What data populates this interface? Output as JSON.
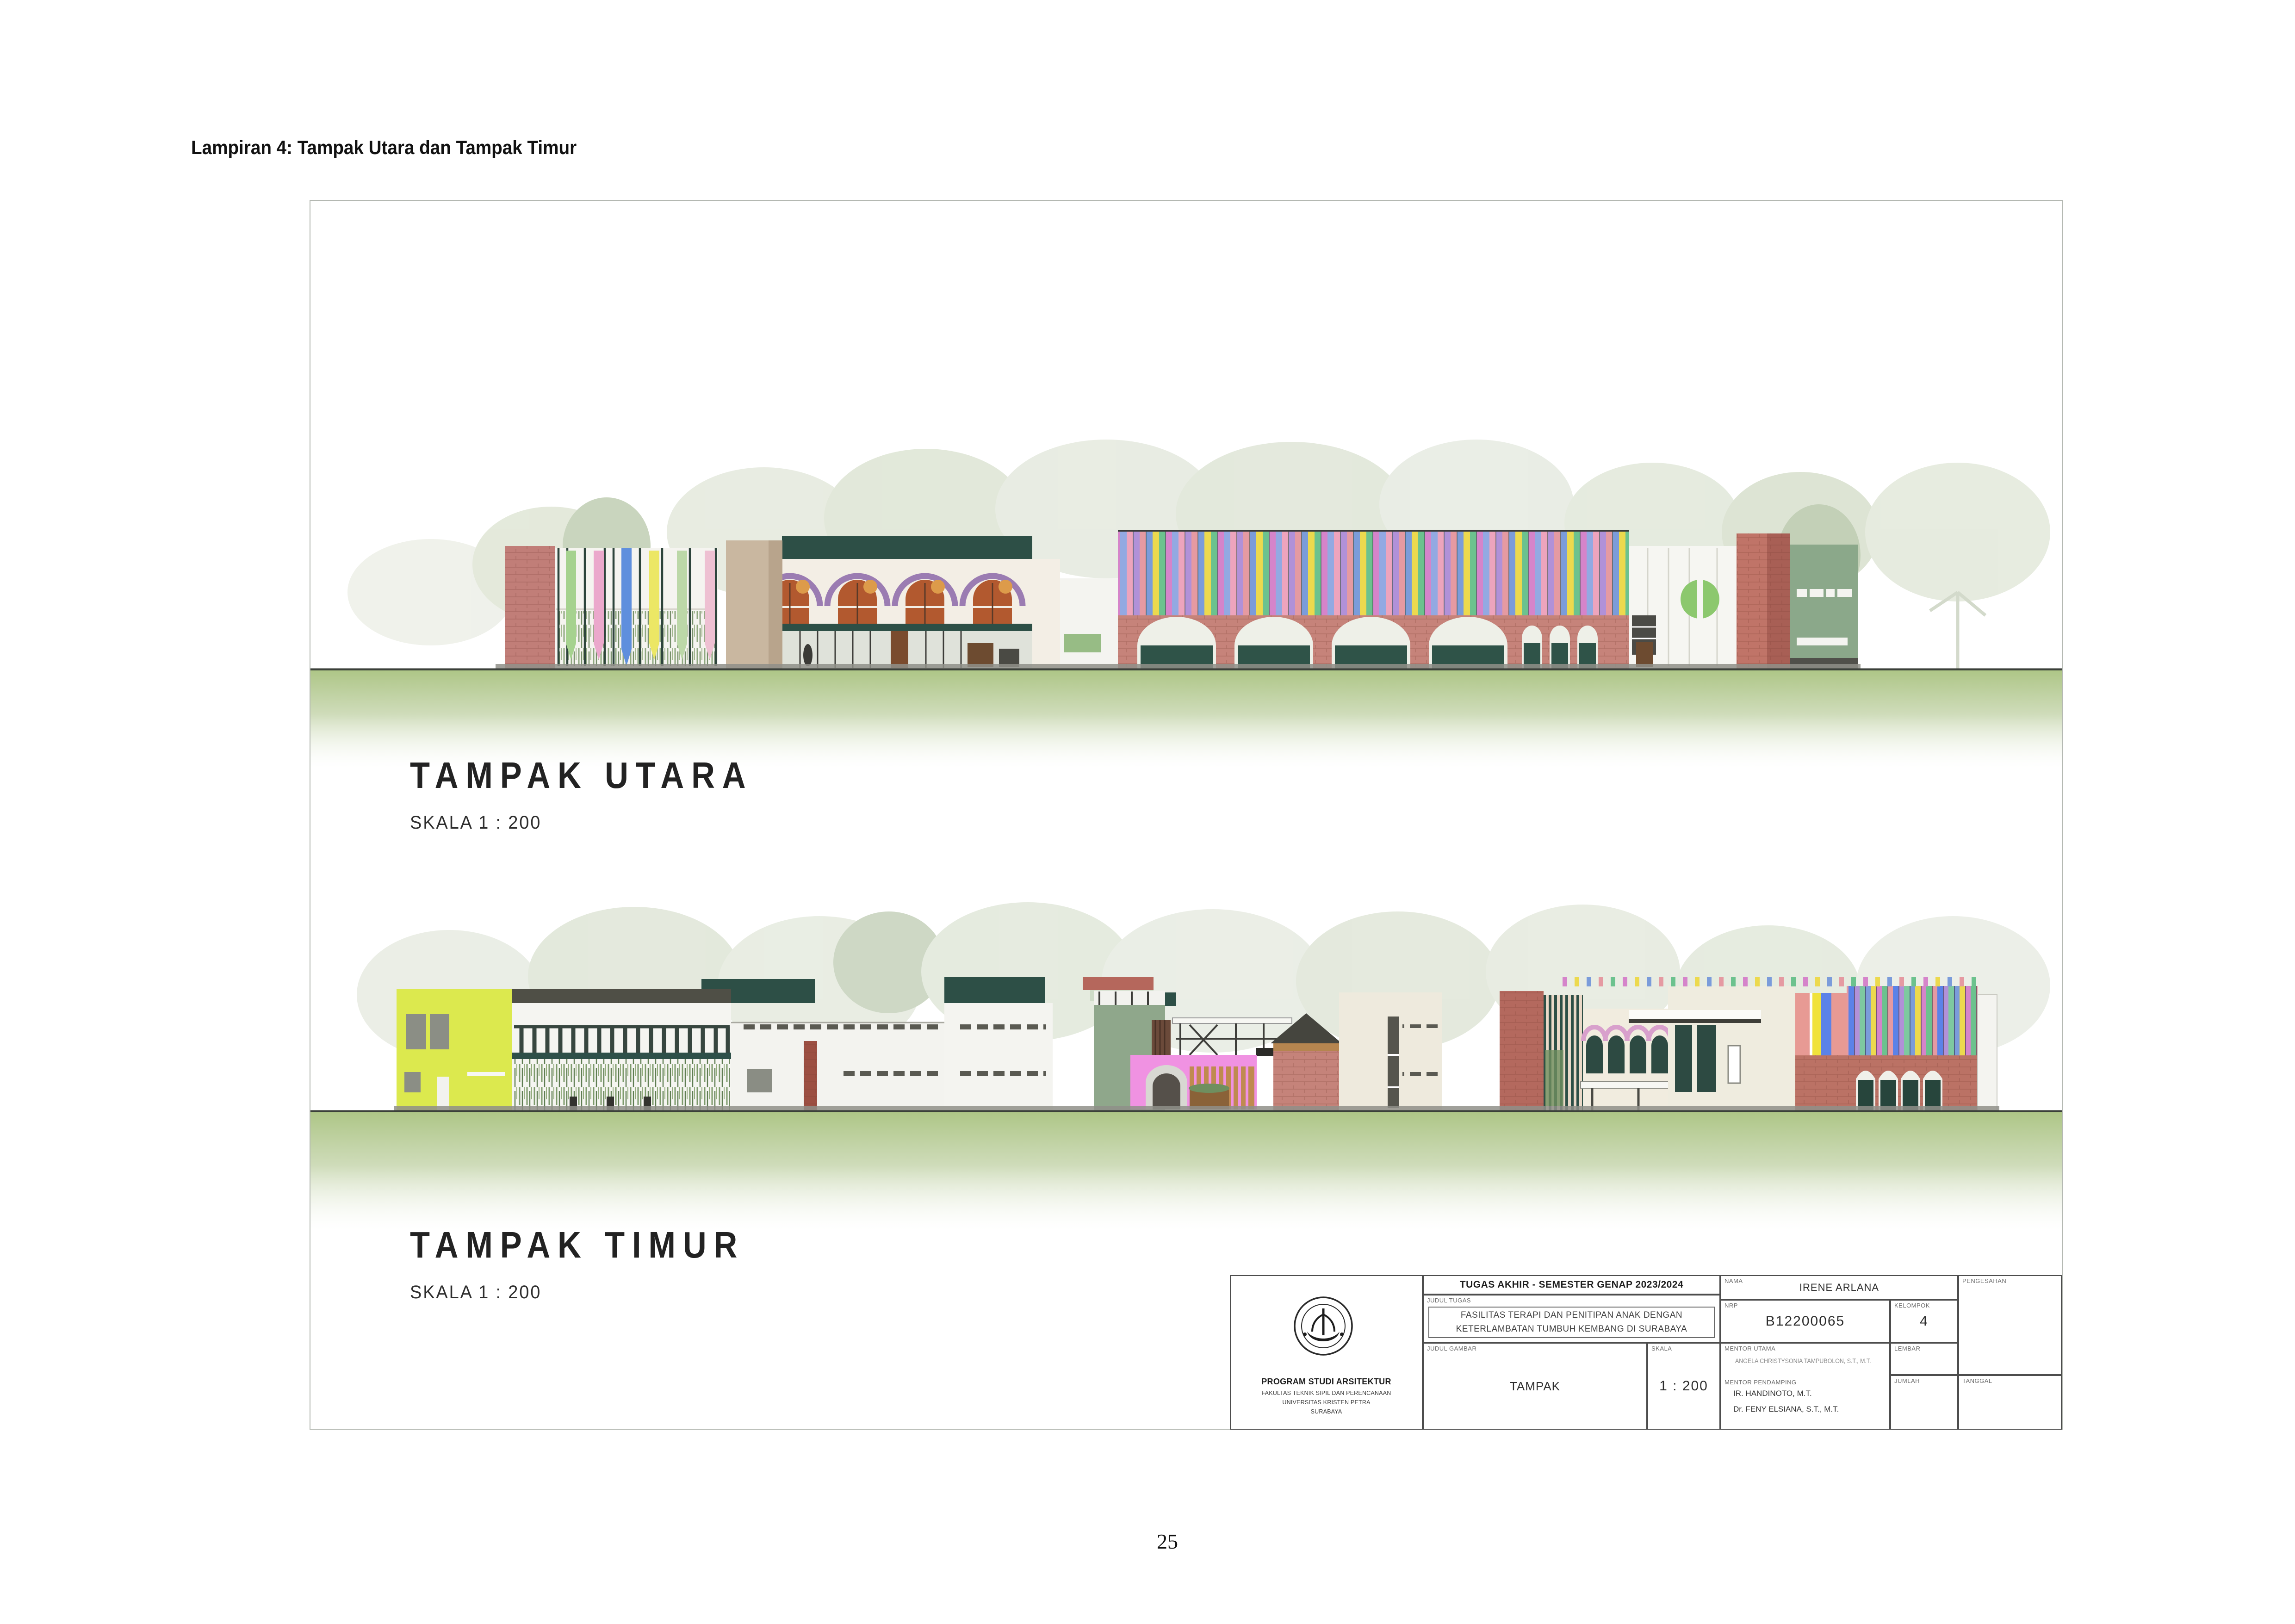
{
  "page": {
    "header": "Lampiran 4: Tampak Utara dan Tampak Timur",
    "page_number": "25"
  },
  "drawings": [
    {
      "id": "north",
      "title": "TAMPAK UTARA",
      "scale_label": "SKALA 1 : 200"
    },
    {
      "id": "east",
      "title": "TAMPAK TIMUR",
      "scale_label": "SKALA 1 : 200"
    }
  ],
  "title_block": {
    "institution": {
      "logo": "universitas-kristen-petra-seal",
      "program": "PROGRAM STUDI ARSITEKTUR",
      "faculty": "FAKULTAS TEKNIK SIPIL DAN PERENCANAAN",
      "university": "UNIVERSITAS KRISTEN PETRA",
      "city": "SURABAYA"
    },
    "project": {
      "header": "TUGAS AKHIR - SEMESTER GENAP 2023/2024",
      "judul_tugas_label": "JUDUL TUGAS",
      "judul_tugas_line1": "FASILITAS TERAPI DAN PENITIPAN ANAK DENGAN",
      "judul_tugas_line2": "KETERLAMBATAN TUMBUH KEMBANG DI SURABAYA",
      "judul_gambar_label": "JUDUL GAMBAR",
      "judul_gambar": "TAMPAK",
      "skala_label": "SKALA",
      "skala": "1 : 200"
    },
    "student": {
      "nama_label": "NAMA",
      "nama": "IRENE ARLANA",
      "nrp_label": "NRP",
      "nrp": "B12200065",
      "kelompok_label": "KELOMPOK",
      "kelompok": "4"
    },
    "mentors": {
      "mentor_utama_label": "MENTOR UTAMA",
      "mentor_utama": "ANGELA CHRISTYSONIA TAMPUBOLON, S.T., M.T.",
      "mentor_pendamping_label": "MENTOR PENDAMPING",
      "mentor_pendamping_1": "IR. HANDINOTO, M.T.",
      "mentor_pendamping_2": "Dr. FENY ELSIANA, S.T., M.T."
    },
    "admin": {
      "lembar_label": "LEMBAR",
      "jumlah_label": "JUMLAH",
      "tanggal_label": "TANGGAL",
      "pengesahan_label": "PENGESAHAN"
    }
  },
  "colors": {
    "ground_green": "#aec687",
    "brick_pink": "#c6837a",
    "brick_red": "#a85f55",
    "dark_teal": "#2d4f46",
    "sage_green": "#8ba88a",
    "lime_green": "#dce94e",
    "bright_pink": "#f092e2",
    "arch_purple": "#9b7cb2",
    "stripe_blue": "#7b9cda",
    "stripe_yellow": "#ecd94e",
    "stripe_green": "#6cc28e",
    "stripe_magenta": "#d584ca",
    "stripe_salmon": "#e59aa2"
  }
}
